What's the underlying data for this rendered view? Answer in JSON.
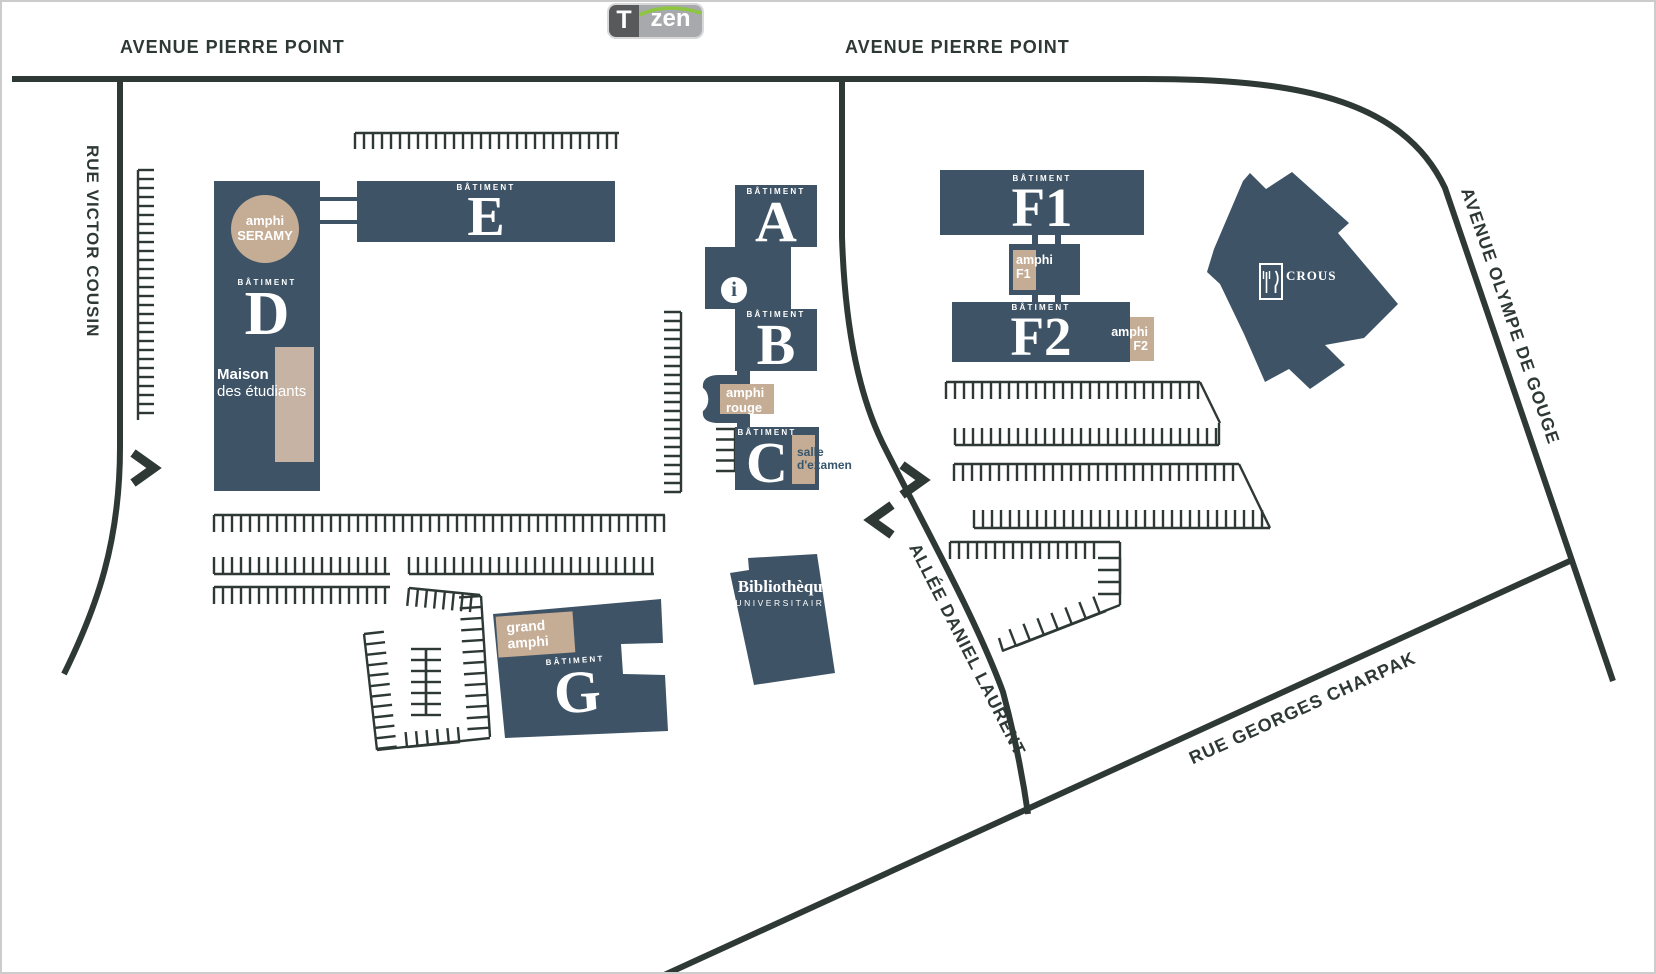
{
  "logo": {
    "t": "T",
    "zen": "zen"
  },
  "streets": {
    "avenue_pierre_point_left": "AVENUE PIERRE POINT",
    "avenue_pierre_point_right": "AVENUE PIERRE POINT",
    "rue_victor_cousin": "RUE VICTOR COUSIN",
    "avenue_olympe_de_gouge": "AVENUE OLYMPE DE GOUGE",
    "allee_daniel_laurent": "ALLÉE DANIEL LAURENT",
    "rue_georges_charpak": "RUE GEORGES CHARPAK"
  },
  "buildings": {
    "batiment_word": "BÂTIMENT",
    "d": {
      "letter": "D"
    },
    "e": {
      "letter": "E"
    },
    "a": {
      "letter": "A"
    },
    "b": {
      "letter": "B"
    },
    "c": {
      "letter": "C"
    },
    "f1": {
      "letter": "F1"
    },
    "f2": {
      "letter": "F2"
    },
    "g": {
      "letter": "G"
    },
    "library": {
      "line1": "Bibliothèque",
      "line2": "UNIVERSITAIRE"
    },
    "crous": {
      "label": "CROUS"
    }
  },
  "places": {
    "amphi_seramy": {
      "line1": "amphi",
      "line2": "SERAMY"
    },
    "maison_etudiants": {
      "line1": "Maison",
      "line2": "des étudiants"
    },
    "amphi_rouge": {
      "line1": "amphi",
      "line2": "rouge"
    },
    "salle_examen": {
      "line1": "salle",
      "line2": "d'examen"
    },
    "amphi_f1": {
      "line1": "amphi",
      "line2": "F1"
    },
    "amphi_f2": {
      "line1": "amphi",
      "line2": "F2"
    },
    "grand_amphi": {
      "line1": "grand",
      "line2": "amphi"
    },
    "info": "i"
  },
  "colors": {
    "building": "#3e5366",
    "tan": "#c4ac95",
    "road": "#2e3935",
    "salle_text": "#37566d",
    "logo_dark": "#58595b",
    "logo_light": "#a7a9ac",
    "logo_green": "#8dc63f"
  }
}
